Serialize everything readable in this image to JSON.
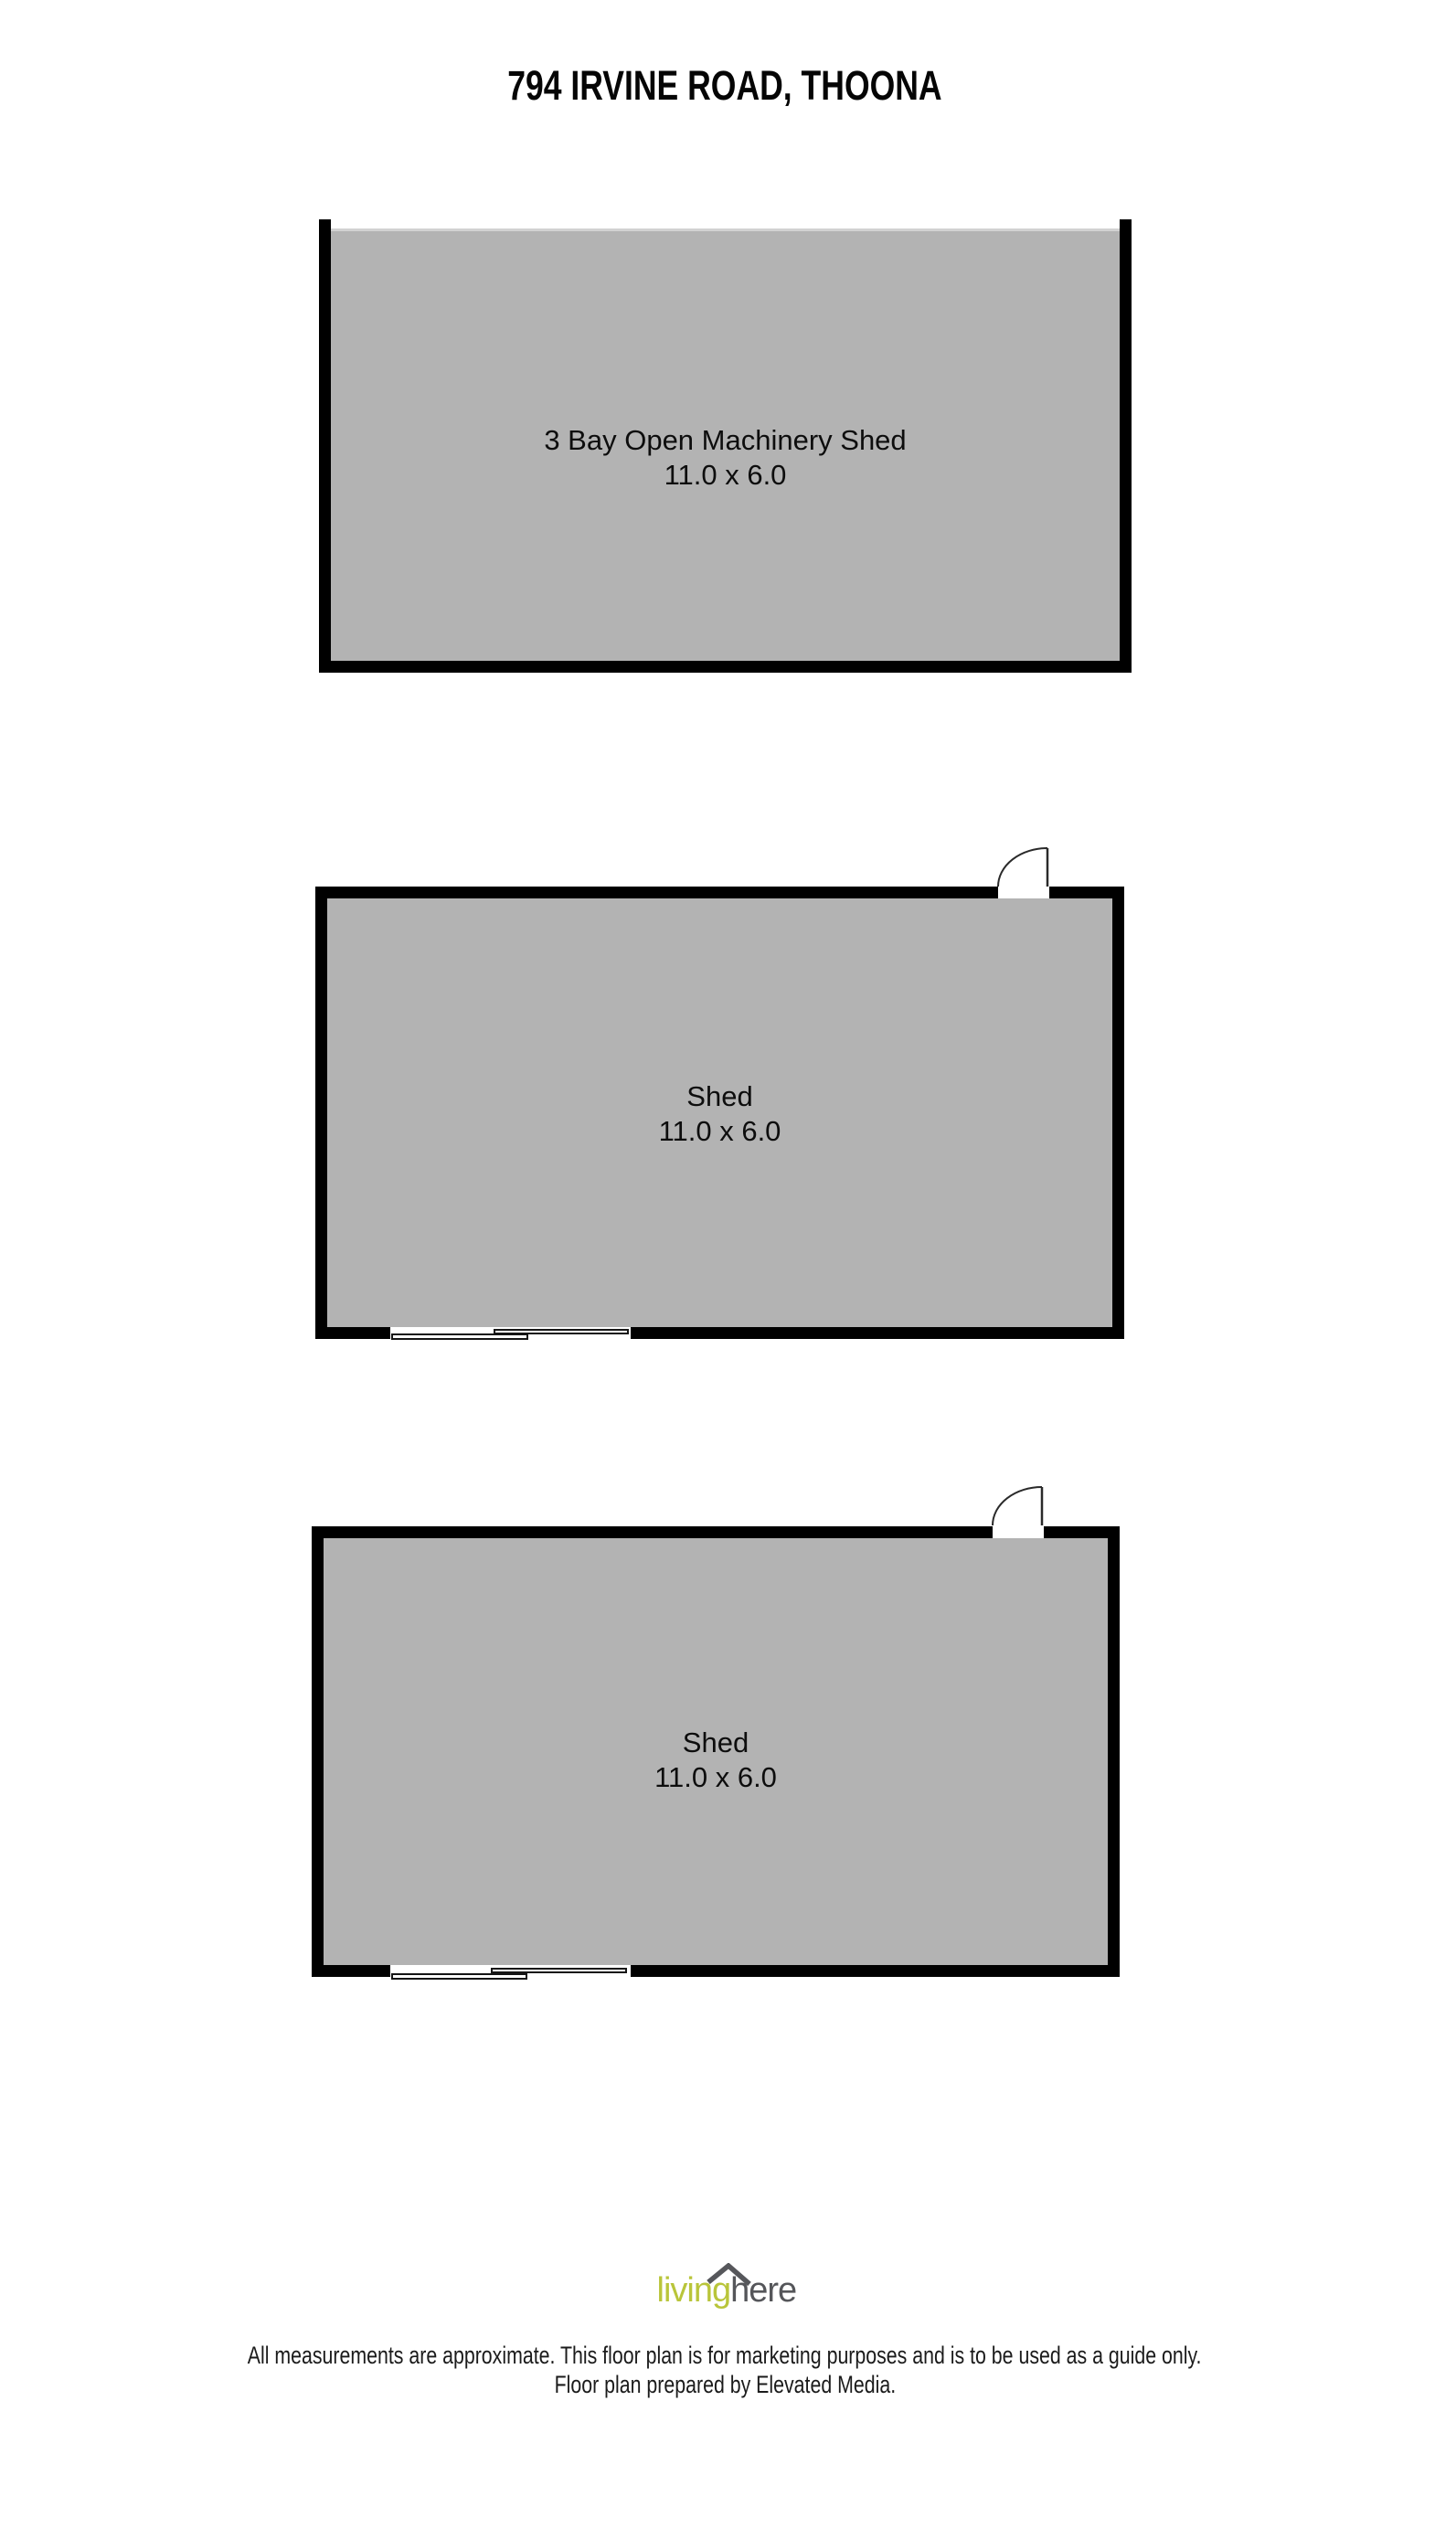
{
  "page": {
    "title": "794 IRVINE ROAD, THOONA"
  },
  "rooms": [
    {
      "name": "3 Bay Open Machinery Shed",
      "dimensions": "11.0 x 6.0",
      "note": "open front, no top wall"
    },
    {
      "name": "Shed",
      "dimensions": "11.0 x 6.0",
      "note": "swing door top right, sliding door bottom left"
    },
    {
      "name": "Shed",
      "dimensions": "11.0 x 6.0",
      "note": "swing door top right, sliding door bottom left"
    }
  ],
  "footer": {
    "logo": {
      "living": "living",
      "here": "here",
      "icon": "roof-icon"
    },
    "disclaimer_line1": "All measurements are approximate. This floor plan is for marketing purposes and is to be used as a guide only.",
    "disclaimer_line2": "Floor plan prepared by Elevated Media."
  },
  "colors": {
    "floor_fill": "#b3b3b3",
    "wall": "#000000",
    "logo_green": "#b9c53a",
    "logo_gray": "#55565a"
  }
}
